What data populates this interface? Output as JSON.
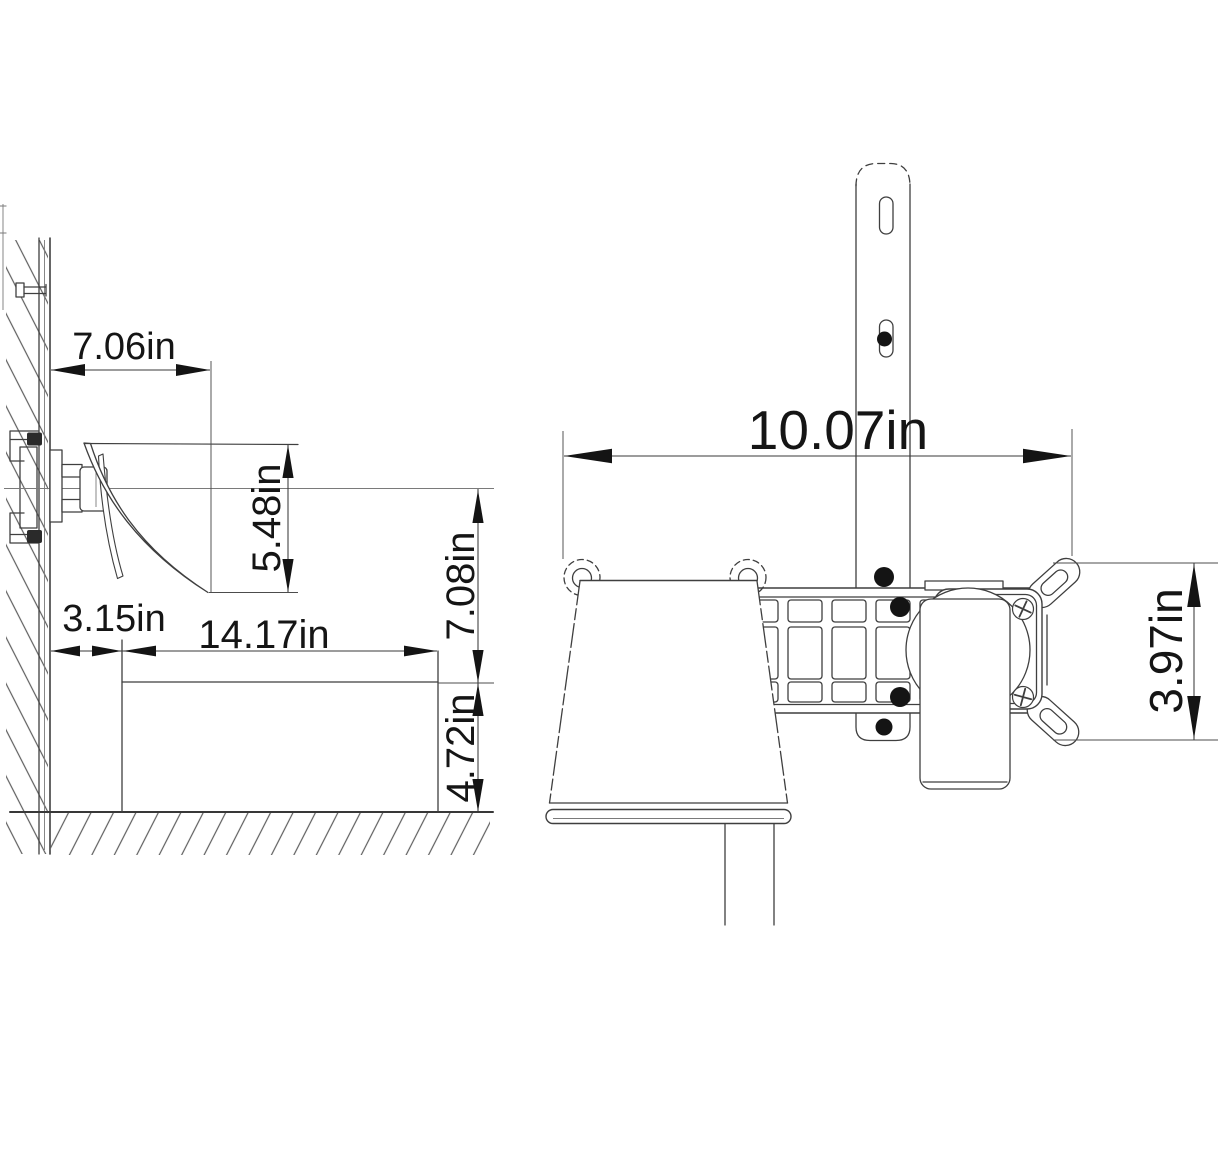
{
  "drawing": {
    "background_color": "#ffffff",
    "line_color": "#3f3f3f",
    "text_color": "#151515",
    "side_view": {
      "spout_projection": "7.06in",
      "spout_drop": "5.48in",
      "outlet_height": "7.08in",
      "wall_clearance": "3.15in",
      "deck_width": "14.17in",
      "deck_height": "4.72in"
    },
    "front_view": {
      "overall_width": "10.07in",
      "trim_height": "3.97in"
    }
  }
}
